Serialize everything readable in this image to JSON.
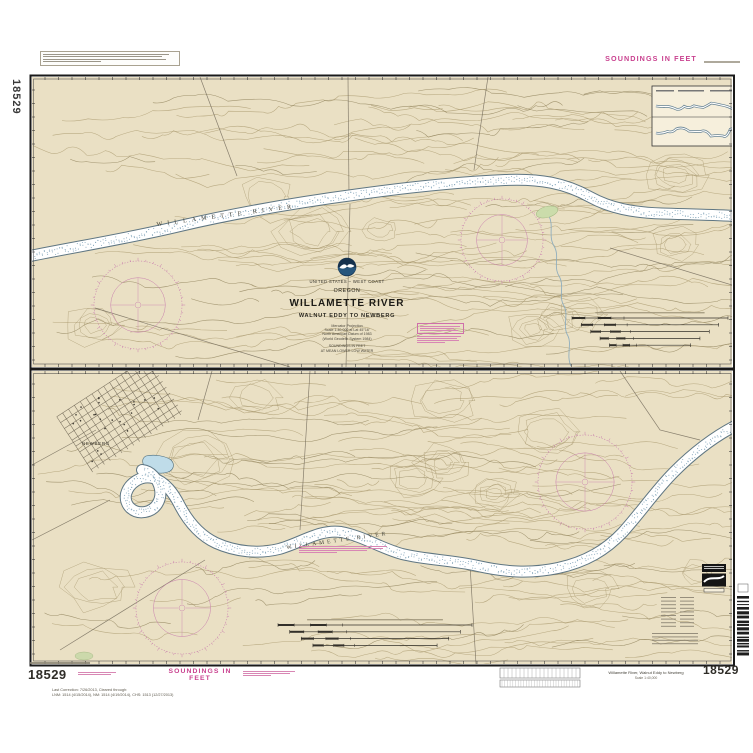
{
  "sheet": {
    "chart_number": "18529",
    "soundings_note_top": "SOUNDINGS IN FEET",
    "soundings_note_bottom": "SOUNDINGS IN FEET",
    "last_correction": {
      "line1": "Last Correction: 7/26/2013,  Cleared through:",
      "line2": "LNM: 1514 (4/15/2014),  NM: 1514 (4/19/2014),  CHS: 1513 (12/27/2013)"
    },
    "bottom_caption": {
      "title": "Willamette River, Walnut Eddy to Newberg",
      "subtitle": "Scale 1:40,000"
    }
  },
  "title_block": {
    "agency_line": "UNITED STATES – WEST COAST",
    "state": "OREGON",
    "title": "WILLAMETTE RIVER",
    "subtitle": "WALNUT EDDY TO NEWBERG",
    "projection_lines": [
      "Mercator Projection",
      "Scale 1:40,000 at Lat 45°16'",
      "North American Datum of 1983",
      "(World Geodetic System 1984)"
    ],
    "datum_lines": [
      "SOUNDINGS IN FEET",
      "AT MEAN LOWER LOW WATER"
    ]
  },
  "map_labels": {
    "river_label_upper": "WILLAMETTE RIVER",
    "river_label_lower": "WILLAMETTE RIVER",
    "town_label": "NEWBERG"
  },
  "icons": {
    "noaa_logo": "noaa-seagull-emblem",
    "compass_rose": "magenta-compass-rose",
    "barcode": "vertical-barcode"
  },
  "colors": {
    "land": "#eae0c4",
    "contour": "#a4936a",
    "water_outline": "#57707e",
    "magenta": "#c9418f",
    "pond": "#bfdce9"
  }
}
